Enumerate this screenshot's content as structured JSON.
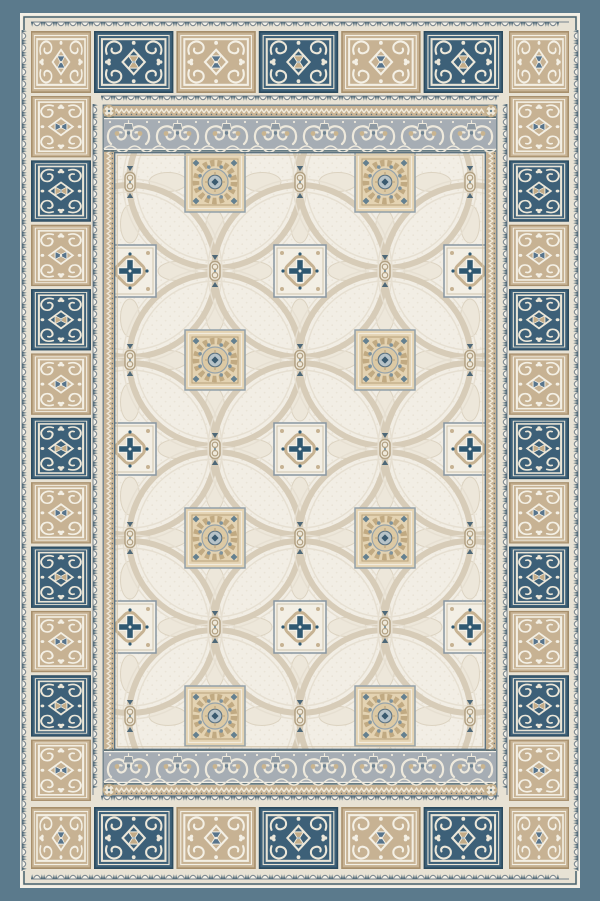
{
  "image": {
    "description": "Top-down product photo of a rectangular ornamental area rug in slate blue, beige and ivory. A solid slate-blue ground surrounds a border of alternating navy and beige scrollwork tile panels framed by scalloped ivory ribbons. The ivory centre field is patterned with interlaced beige circles, beige floral medallion squares, smaller ivory squares with steel-blue cross centres, chain-link knots, and gray scrollwork friezes across the top and bottom.",
    "subject": "ornamental area rug",
    "view": "top-down"
  },
  "palette": {
    "background_blue": "#5b7a8c",
    "cream": "#e8e2d4",
    "ivory": "#f3f0e7",
    "frame_dark": "#47626f",
    "slate": "#5c7280",
    "scallop_line": "#76838d",
    "scallop_tooth": "#4e6878",
    "field_bg": "#f2eee5",
    "field_dot": "#eae4d7",
    "ring": "#d7ccb8",
    "ring_light": "#e6dfd1",
    "petal_fill": "#ede7da",
    "petal_line": "#dcd3c1",
    "frieze_bg": "#a6adb4",
    "frieze_scroll": "#eee9dc",
    "frieze_accent": "#c9b48f",
    "frieze_bell": "#8e99a2",
    "frieze_bell_dark": "#6d8290",
    "ministrip_bg": "#c9b495",
    "ministrip_zig": "#f0ebdd",
    "ministrip_dot": "#5d7280",
    "tiles": {
      "blue": {
        "bg": "#3d6078",
        "edge": "#2b4a5e",
        "line": "#e9e4d6",
        "orn": "#ece7d9",
        "ctr": "#c3ac88",
        "ctrLine": "#f0ece0",
        "dot": "#a9bcc6"
      },
      "beige": {
        "bg": "#c7b293",
        "edge": "#a78f6c",
        "line": "#f3efe4",
        "orn": "#f4f0e5",
        "ctr": "#57748c",
        "ctrLine": "#f3efe4",
        "dot": "#f3efe4"
      }
    },
    "mandala": {
      "bg": "#e4d3b2",
      "frame": "#92a0a9",
      "light": "#f1ebdc",
      "tan": "#b7a17b",
      "corner_blue": "#64808f",
      "petal": "#c1aa82",
      "inner": "#dcc9a4",
      "ring_line": "#97a4ab",
      "dot": "#7b919d",
      "core": "#b7c3c8",
      "core_line": "#5e7585",
      "center": "#3a5a6f"
    },
    "cross": {
      "bg": "#f3efe5",
      "frame": "#8795a1",
      "inner_line": "#cfc4ae",
      "scroll": "#c6b292",
      "scroll_fill": "#ebe3d3",
      "blue": "#2f5871",
      "ivory": "#f4f1e8"
    },
    "link": {
      "fill": "#efe9db",
      "stroke": "#b3a284",
      "accent": "#63808f",
      "tri": "#4e6878"
    },
    "floret": {
      "fill": "#efe9db",
      "stroke": "#c2ae8c",
      "dot": "#63808f"
    }
  },
  "border": {
    "top_row": [
      "beige",
      "blue",
      "beige",
      "blue",
      "beige",
      "blue",
      "beige"
    ],
    "bottom_row": [
      "beige",
      "blue",
      "beige",
      "blue",
      "beige",
      "blue",
      "beige"
    ],
    "left_column": [
      "beige",
      "blue",
      "beige",
      "blue",
      "beige",
      "blue",
      "beige",
      "blue",
      "beige",
      "blue",
      "beige"
    ],
    "right_column": [
      "beige",
      "blue",
      "beige",
      "blue",
      "beige",
      "blue",
      "beige",
      "blue",
      "beige",
      "blue",
      "beige"
    ],
    "blue_tile_motif": "ivory scrollwork around a beige hourglass medallion",
    "beige_tile_motif": "ivory scrollwork around a steel-blue diamond medallion",
    "blue_tile_count": 16,
    "beige_tile_count": 20
  },
  "field": {
    "pattern": "interlaced circle lattice",
    "medallion_square_count": 8,
    "cross_square_count": 9,
    "chain_link_count": 18,
    "ring_radius": 86,
    "medallion_cols": [
      215,
      385
    ],
    "medallion_rows": [
      182,
      360,
      538,
      716
    ],
    "cross_cols": [
      130,
      300,
      470
    ],
    "cross_rows": [
      271,
      449,
      627
    ]
  },
  "friezes": {
    "count": 2,
    "position": "top and bottom of field",
    "motif": "gray band of paired ivory volute scrolls with hanging lamps"
  },
  "ribbons": {
    "count": 8,
    "motif": "ivory scallops with dark pointed teeth"
  }
}
